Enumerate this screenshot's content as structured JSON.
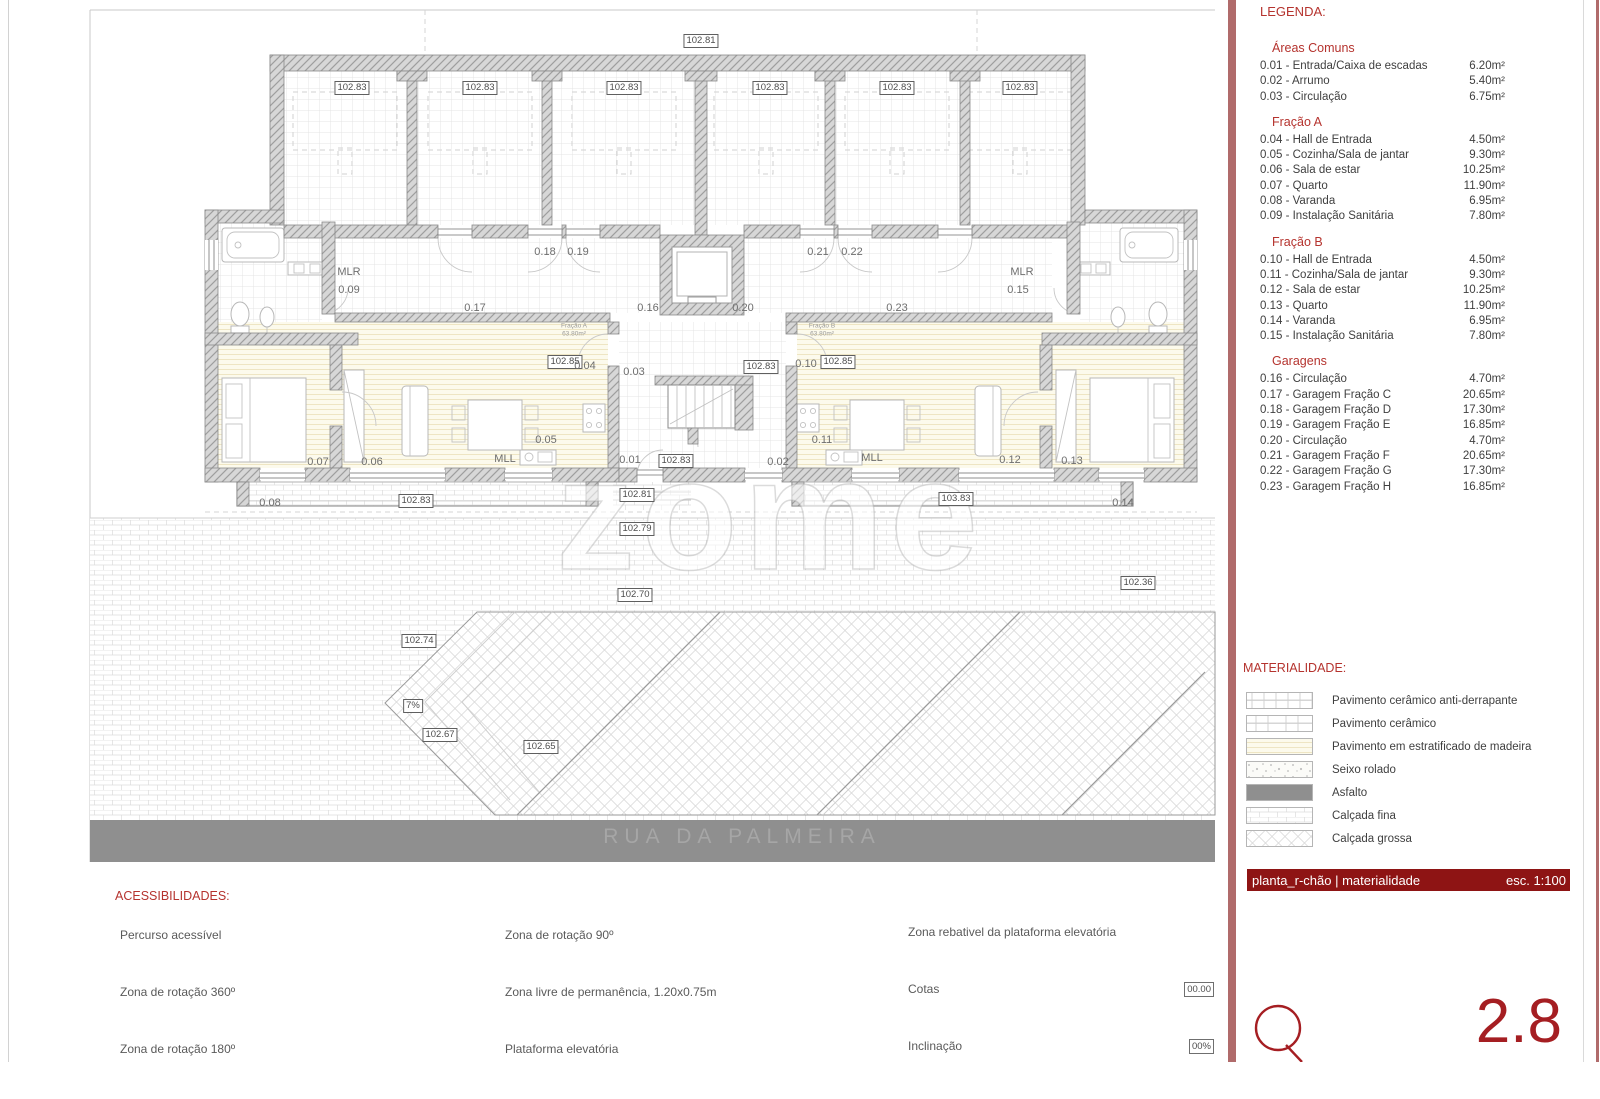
{
  "legend": {
    "title": "LEGENDA:",
    "sections": [
      {
        "title": "Áreas Comuns",
        "items": [
          {
            "label": "0.01 - Entrada/Caixa de escadas",
            "area": "6.20m²"
          },
          {
            "label": "0.02 - Arrumo",
            "area": "5.40m²"
          },
          {
            "label": "0.03 - Circulação",
            "area": "6.75m²"
          }
        ]
      },
      {
        "title": "Fração A",
        "items": [
          {
            "label": "0.04 - Hall de Entrada",
            "area": "4.50m²"
          },
          {
            "label": "0.05 - Cozinha/Sala de jantar",
            "area": "9.30m²"
          },
          {
            "label": "0.06 - Sala de estar",
            "area": "10.25m²"
          },
          {
            "label": "0.07 - Quarto",
            "area": "11.90m²"
          },
          {
            "label": "0.08 - Varanda",
            "area": "6.95m²"
          },
          {
            "label": "0.09 - Instalação Sanitária",
            "area": "7.80m²"
          }
        ]
      },
      {
        "title": "Fração B",
        "items": [
          {
            "label": "0.10 - Hall de Entrada",
            "area": "4.50m²"
          },
          {
            "label": "0.11 - Cozinha/Sala de jantar",
            "area": "9.30m²"
          },
          {
            "label": "0.12 - Sala de estar",
            "area": "10.25m²"
          },
          {
            "label": "0.13 - Quarto",
            "area": "11.90m²"
          },
          {
            "label": "0.14 - Varanda",
            "area": "6.95m²"
          },
          {
            "label": "0.15 - Instalação Sanitária",
            "area": "7.80m²"
          }
        ]
      },
      {
        "title": "Garagens",
        "items": [
          {
            "label": "0.16 - Circulação",
            "area": "4.70m²"
          },
          {
            "label": "0.17 - Garagem Fração C",
            "area": "20.65m²"
          },
          {
            "label": "0.18 - Garagem Fração D",
            "area": "17.30m²"
          },
          {
            "label": "0.19 - Garagem Fração E",
            "area": "16.85m²"
          },
          {
            "label": "0.20 - Circulação",
            "area": "4.70m²"
          },
          {
            "label": "0.21 - Garagem Fração F",
            "area": "20.65m²"
          },
          {
            "label": "0.22 - Garagem Fração G",
            "area": "17.30m²"
          },
          {
            "label": "0.23 - Garagem Fração H",
            "area": "16.85m²"
          }
        ]
      }
    ]
  },
  "materials": {
    "title": "MATERIALIDADE:",
    "items": [
      {
        "name": "Pavimento cerâmico anti-derrapante",
        "pattern": "tileL"
      },
      {
        "name": "Pavimento cerâmico",
        "pattern": "tileM"
      },
      {
        "name": "Pavimento em estratificado de madeira",
        "pattern": "wood"
      },
      {
        "name": "Seixo rolado",
        "pattern": "speckle"
      },
      {
        "name": "Asfalto",
        "pattern": "asphalt"
      },
      {
        "name": "Calçada fina",
        "pattern": "brick"
      },
      {
        "name": "Calçada grossa",
        "pattern": "diamond"
      }
    ]
  },
  "titleblock": {
    "title": "planta_r-chão | materialidade",
    "scale": "esc. 1:100",
    "sheet_number": "2.8",
    "logo_letter": "Q"
  },
  "accessibility": {
    "title": "ACESSIBILIDADES:",
    "col1": [
      "Percurso acessível",
      "Zona de rotação 360º",
      "Zona de rotação 180º"
    ],
    "col2": [
      "Zona de rotação 90º",
      "Zona livre de permanência, 1.20x0.75m",
      "Plataforma elevatória"
    ],
    "col3": [
      {
        "label": "Zona rebativel da plataforma elevatória",
        "value": null
      },
      {
        "label": "Cotas",
        "value": "00.00"
      },
      {
        "label": "Inclinação",
        "value": "00%"
      }
    ]
  },
  "street": {
    "name": "RUA DA PALMEIRA"
  },
  "watermark": "zome",
  "plan": {
    "elevation_labels": [
      {
        "t": "102.81",
        "x": 701,
        "y": 41
      },
      {
        "t": "102.83",
        "x": 352,
        "y": 88
      },
      {
        "t": "102.83",
        "x": 480,
        "y": 88
      },
      {
        "t": "102.83",
        "x": 624,
        "y": 88
      },
      {
        "t": "102.83",
        "x": 770,
        "y": 88
      },
      {
        "t": "102.83",
        "x": 897,
        "y": 88
      },
      {
        "t": "102.83",
        "x": 1020,
        "y": 88
      },
      {
        "t": "102.85",
        "x": 565,
        "y": 362
      },
      {
        "t": "102.85",
        "x": 838,
        "y": 362
      },
      {
        "t": "102.83",
        "x": 761,
        "y": 367
      },
      {
        "t": "102.83",
        "x": 676,
        "y": 461
      },
      {
        "t": "102.83",
        "x": 416,
        "y": 501
      },
      {
        "t": "102.81",
        "x": 637,
        "y": 495
      },
      {
        "t": "103.83",
        "x": 956,
        "y": 499
      },
      {
        "t": "102.79",
        "x": 637,
        "y": 529
      },
      {
        "t": "102.70",
        "x": 635,
        "y": 595
      },
      {
        "t": "102.36",
        "x": 1138,
        "y": 583
      },
      {
        "t": "102.74",
        "x": 419,
        "y": 641
      },
      {
        "t": "102.67",
        "x": 440,
        "y": 735
      },
      {
        "t": "102.65",
        "x": 541,
        "y": 747
      },
      {
        "t": "7%",
        "x": 413,
        "y": 706
      }
    ],
    "room_labels": [
      {
        "t": "MLR",
        "x": 349,
        "y": 272
      },
      {
        "t": "0.09",
        "x": 349,
        "y": 290
      },
      {
        "t": "0.17",
        "x": 475,
        "y": 308
      },
      {
        "t": "0.18",
        "x": 545,
        "y": 252
      },
      {
        "t": "0.19",
        "x": 578,
        "y": 252
      },
      {
        "t": "0.16",
        "x": 648,
        "y": 308
      },
      {
        "t": "0.20",
        "x": 743,
        "y": 308
      },
      {
        "t": "0.21",
        "x": 818,
        "y": 252
      },
      {
        "t": "0.22",
        "x": 852,
        "y": 252
      },
      {
        "t": "0.23",
        "x": 897,
        "y": 308
      },
      {
        "t": "MLR",
        "x": 1022,
        "y": 272
      },
      {
        "t": "0.15",
        "x": 1018,
        "y": 290
      },
      {
        "t": "0.04",
        "x": 585,
        "y": 366
      },
      {
        "t": "0.03",
        "x": 634,
        "y": 372
      },
      {
        "t": "0.10",
        "x": 806,
        "y": 364
      },
      {
        "t": "0.07",
        "x": 318,
        "y": 462
      },
      {
        "t": "0.06",
        "x": 372,
        "y": 462
      },
      {
        "t": "0.05",
        "x": 546,
        "y": 440
      },
      {
        "t": "MLL",
        "x": 505,
        "y": 459
      },
      {
        "t": "0.01",
        "x": 630,
        "y": 460
      },
      {
        "t": "0.02",
        "x": 778,
        "y": 462
      },
      {
        "t": "0.11",
        "x": 822,
        "y": 440
      },
      {
        "t": "MLL",
        "x": 872,
        "y": 458
      },
      {
        "t": "0.12",
        "x": 1010,
        "y": 460
      },
      {
        "t": "0.13",
        "x": 1072,
        "y": 461
      },
      {
        "t": "0.08",
        "x": 270,
        "y": 503
      },
      {
        "t": "0.14",
        "x": 1123,
        "y": 503
      }
    ],
    "fraction_labels": [
      {
        "name": "Fração A",
        "area": "63.80m²",
        "x": 574,
        "y": 330
      },
      {
        "name": "Fração B",
        "area": "63.80m²",
        "x": 822,
        "y": 330
      }
    ]
  },
  "colors": {
    "accent_red": "#b5332e",
    "panel_strip": "#b06b6b",
    "titlebar_bg": "#8e1414",
    "sheet_red": "#a51e22",
    "asphalt": "#8f8f8f",
    "text": "#3d3d3d"
  }
}
